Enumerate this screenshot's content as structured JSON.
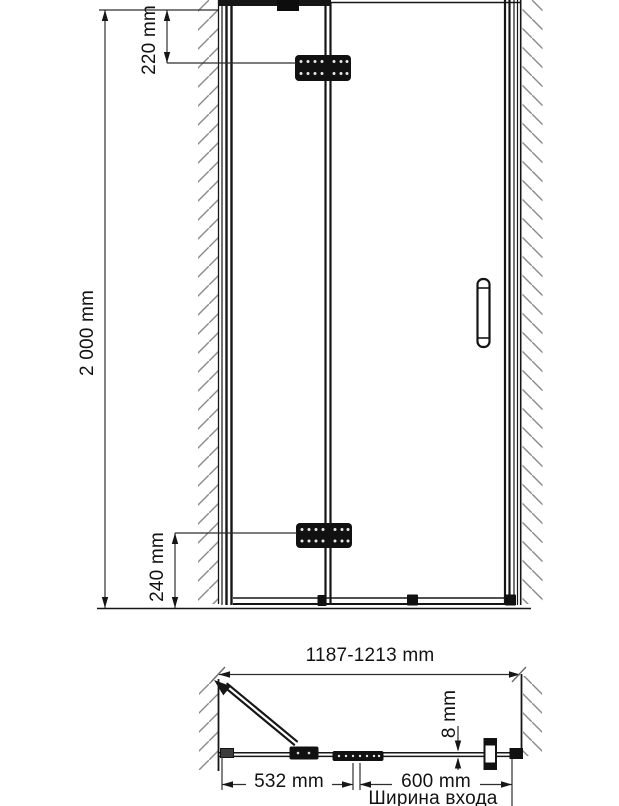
{
  "diagram": {
    "front_view": {
      "height": "2 000 mm",
      "top_hinge_offset": "220 mm",
      "bottom_hinge_offset": "240 mm"
    },
    "plan_view": {
      "overall_width": "1187-1213 mm",
      "door_leaf_width": "532 mm",
      "entrance_width": "600 mm",
      "entrance_caption": "Ширина входа",
      "glass_thickness": "8 mm"
    },
    "colors": {
      "line": "#161616",
      "dimension": "#2e2e2e",
      "hatch": "#8a8a8a",
      "fitting": "#111111",
      "background": "#ffffff"
    }
  }
}
